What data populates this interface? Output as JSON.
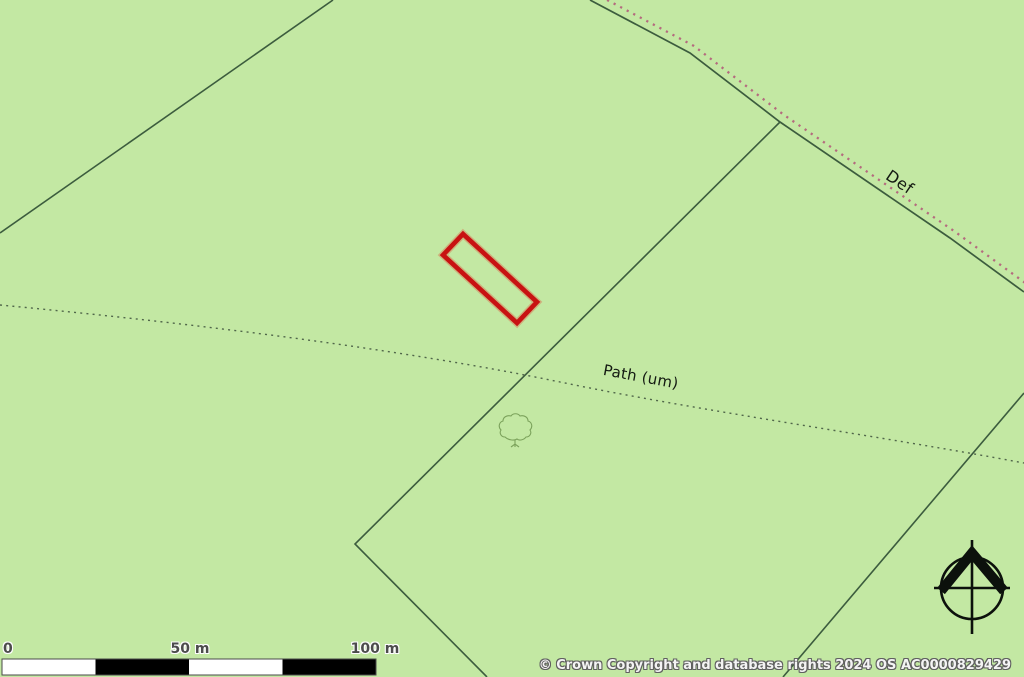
{
  "map": {
    "labels": {
      "boundary_def": "Def",
      "path": "Path (um)"
    },
    "icons": {
      "north_pointer": "compass-north-icon",
      "tree": "deciduous-tree-icon"
    },
    "colors": {
      "background": "#c3e8a3",
      "field_line": "#3c5c3e",
      "parish_dots": "#b46b7e",
      "path_dots": "#50664a",
      "plot_outline": "#c81212",
      "plot_halo": "rgba(225,75,55,0.35)",
      "compass": "#0c110c",
      "tree_line": "#7ba25b"
    }
  },
  "scale_bar": {
    "ticks": [
      "0",
      "50 m",
      "100 m"
    ]
  },
  "attribution": "© Crown Copyright and database rights 2024 OS AC0000829429"
}
